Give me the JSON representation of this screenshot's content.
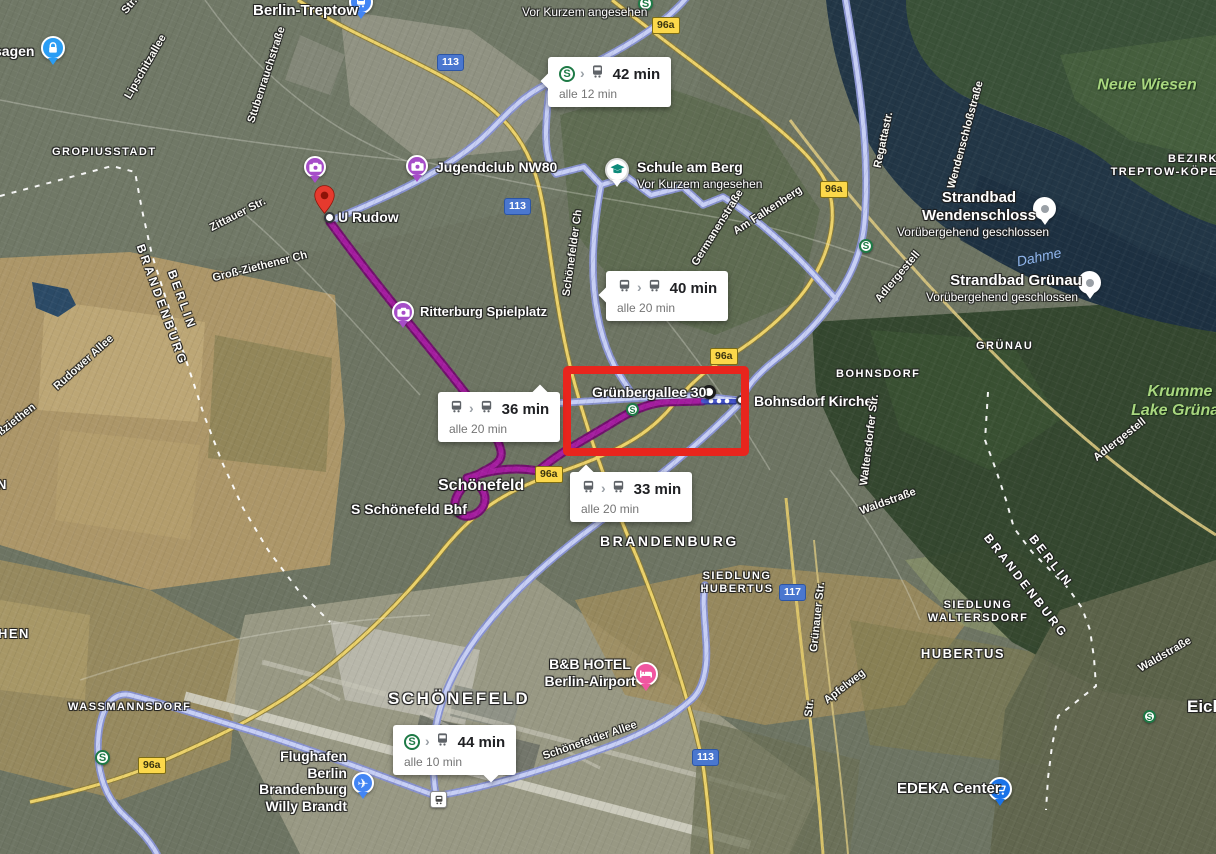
{
  "map": {
    "colors": {
      "transit_route": "#c7cff5",
      "transit_casing": "#8791cf",
      "selected_route": "#a31c9e",
      "selected_casing": "#70106c",
      "blue_route": "#4251c9",
      "blue_casing": "#2b379b",
      "sbahn_green": "#1e7a46",
      "badge_yellow": "#fcd84a",
      "highway_blue": "#4a77cf",
      "highlight_red": "#e8251d"
    },
    "bubbles": [
      {
        "time": "42 min",
        "frequency": "alle 12 min",
        "icons": [
          "sbahn",
          "chevron",
          "train"
        ],
        "x": 548,
        "y": 57,
        "pointer": "left"
      },
      {
        "time": "40 min",
        "frequency": "alle 20 min",
        "icons": [
          "bus",
          "chevron",
          "bus"
        ],
        "x": 606,
        "y": 271,
        "pointer": "left"
      },
      {
        "time": "36 min",
        "frequency": "alle 20 min",
        "icons": [
          "bus",
          "chevron",
          "bus"
        ],
        "x": 438,
        "y": 392,
        "pointer": "top-right"
      },
      {
        "time": "33 min",
        "frequency": "alle 20 min",
        "icons": [
          "bus",
          "chevron",
          "bus"
        ],
        "x": 570,
        "y": 472,
        "pointer": "top-left"
      },
      {
        "time": "44 min",
        "frequency": "alle 10 min",
        "icons": [
          "sbahn",
          "chevron",
          "train"
        ],
        "x": 393,
        "y": 725,
        "pointer": "bottom"
      }
    ],
    "labels": [
      {
        "lines": [
          "Berlin-Treptow"
        ],
        "x": 253,
        "y": 2,
        "kind": "poi",
        "size": 15
      },
      {
        "lines": [
          "Vor Kurzem angesehen"
        ],
        "x": 522,
        "y": 5,
        "kind": "poi-sub"
      },
      {
        "lines": [
          "sagen"
        ],
        "x": -6,
        "y": 43,
        "kind": "poi"
      },
      {
        "lines": [
          "Jugendclub NW80"
        ],
        "x": 436,
        "y": 159,
        "kind": "poi"
      },
      {
        "lines": [
          "U Rudow"
        ],
        "x": 338,
        "y": 209,
        "kind": "poi"
      },
      {
        "lines": [
          "Schule am Berg"
        ],
        "x": 637,
        "y": 159,
        "kind": "poi"
      },
      {
        "lines": [
          "Vor Kurzem angesehen"
        ],
        "x": 637,
        "y": 177,
        "kind": "poi-sub"
      },
      {
        "lines": [
          "Ritterburg Spielplatz"
        ],
        "x": 420,
        "y": 304,
        "kind": "poi",
        "size": 13
      },
      {
        "lines": [
          "Grünbergallee 30"
        ],
        "x": 592,
        "y": 384,
        "kind": "poi"
      },
      {
        "lines": [
          "Bohnsdorf Kirche"
        ],
        "x": 754,
        "y": 393,
        "kind": "poi"
      },
      {
        "lines": [
          "Schönefeld"
        ],
        "x": 438,
        "y": 477,
        "kind": "poi",
        "size": 16
      },
      {
        "lines": [
          "S Schönefeld Bhf"
        ],
        "x": 351,
        "y": 501,
        "kind": "poi"
      },
      {
        "lines": [
          "B&B HOTEL",
          "Berlin-Airport"
        ],
        "x": 590,
        "y": 656,
        "kind": "poi",
        "anchor": "center"
      },
      {
        "lines": [
          "Flughafen",
          "Berlin",
          "Brandenburg",
          "Willy Brandt"
        ],
        "x": 347,
        "y": 748,
        "kind": "poi",
        "anchor": "right"
      },
      {
        "lines": [
          "EDEKA Center"
        ],
        "x": 897,
        "y": 780,
        "kind": "poi",
        "size": 15
      },
      {
        "lines": [
          "Strandbad",
          "Wendenschloss"
        ],
        "x": 979,
        "y": 189,
        "kind": "poi",
        "size": 15,
        "anchor": "center"
      },
      {
        "lines": [
          "Vorübergehend geschlossen"
        ],
        "x": 973,
        "y": 225,
        "kind": "poi-sub",
        "anchor": "center"
      },
      {
        "lines": [
          "Strandbad Grünau"
        ],
        "x": 1016,
        "y": 272,
        "kind": "poi",
        "size": 15,
        "anchor": "center"
      },
      {
        "lines": [
          "Vorübergehend geschlossen"
        ],
        "x": 1002,
        "y": 290,
        "kind": "poi-sub",
        "anchor": "center"
      },
      {
        "lines": [
          "Eichw"
        ],
        "x": 1187,
        "y": 697,
        "kind": "poi",
        "size": 17
      },
      {
        "lines": [
          "GROPIUSSTADT"
        ],
        "x": 52,
        "y": 146,
        "kind": "area"
      },
      {
        "lines": [
          "BOHNSDORF"
        ],
        "x": 836,
        "y": 368,
        "kind": "area"
      },
      {
        "lines": [
          "GRÜNAU"
        ],
        "x": 976,
        "y": 340,
        "kind": "area"
      },
      {
        "lines": [
          "BEZIRK",
          "TREPTOW-KÖPE"
        ],
        "x": 1218,
        "y": 153,
        "kind": "area",
        "anchor": "right"
      },
      {
        "lines": [
          "WASSMANNSDORF"
        ],
        "x": 68,
        "y": 701,
        "kind": "area"
      },
      {
        "lines": [
          "SIEDLUNG",
          "HUBERTUS"
        ],
        "x": 737,
        "y": 570,
        "kind": "area",
        "anchor": "center"
      },
      {
        "lines": [
          "SIEDLUNG",
          "WALTERSDORF"
        ],
        "x": 978,
        "y": 599,
        "kind": "area",
        "anchor": "center"
      },
      {
        "lines": [
          "HUBERTUS"
        ],
        "x": 963,
        "y": 646,
        "kind": "area",
        "size": 13,
        "anchor": "center"
      },
      {
        "lines": [
          "SCHÖNEFELD"
        ],
        "x": 388,
        "y": 689,
        "kind": "area-big"
      },
      {
        "lines": [
          "BRANDENBURG"
        ],
        "x": 600,
        "y": 533,
        "kind": "area-big",
        "size": 14
      },
      {
        "lines": [
          "HEN"
        ],
        "x": -2,
        "y": 626,
        "kind": "area",
        "size": 13
      },
      {
        "lines": [
          "N"
        ],
        "x": -3,
        "y": 477,
        "kind": "area",
        "size": 13
      },
      {
        "lines": [
          "BERLIN"
        ],
        "x": 182,
        "y": 300,
        "kind": "area-border",
        "rot": 70
      },
      {
        "lines": [
          "BRANDENBURG"
        ],
        "x": 162,
        "y": 305,
        "kind": "area-border",
        "rot": 70
      },
      {
        "lines": [
          "BERLIN"
        ],
        "x": 1051,
        "y": 561,
        "kind": "area-border",
        "rot": 52
      },
      {
        "lines": [
          "BRANDENBURG"
        ],
        "x": 1026,
        "y": 586,
        "kind": "area-border",
        "rot": 52
      },
      {
        "lines": [
          "Lipschitzallee"
        ],
        "x": 146,
        "y": 67,
        "kind": "street",
        "rot": -60
      },
      {
        "lines": [
          "Stubenrauchstraße"
        ],
        "x": 267,
        "y": 75,
        "kind": "street",
        "rot": -72
      },
      {
        "lines": [
          "Str."
        ],
        "x": 130,
        "y": 6,
        "kind": "street",
        "rot": -50
      },
      {
        "lines": [
          "Zittauer Str."
        ],
        "x": 238,
        "y": 215,
        "kind": "street",
        "rot": -27
      },
      {
        "lines": [
          "Groß-Ziethener Ch"
        ],
        "x": 260,
        "y": 267,
        "kind": "street",
        "rot": -14
      },
      {
        "lines": [
          "Rudower Allee"
        ],
        "x": 84,
        "y": 363,
        "kind": "street",
        "rot": -42
      },
      {
        "lines": [
          "ßziethen"
        ],
        "x": 17,
        "y": 420,
        "kind": "street",
        "rot": -38
      },
      {
        "lines": [
          "Schönefelder Ch"
        ],
        "x": 573,
        "y": 253,
        "kind": "street",
        "rot": -82
      },
      {
        "lines": [
          "Germanenstraße"
        ],
        "x": 718,
        "y": 228,
        "kind": "street",
        "rot": -58
      },
      {
        "lines": [
          "Am Falkenberg"
        ],
        "x": 768,
        "y": 211,
        "kind": "street",
        "rot": -33
      },
      {
        "lines": [
          "Adlergestell"
        ],
        "x": 898,
        "y": 277,
        "kind": "street",
        "rot": -50
      },
      {
        "lines": [
          "Regattastr."
        ],
        "x": 884,
        "y": 140,
        "kind": "street",
        "rot": -78
      },
      {
        "lines": [
          "Wendenschloßstraße"
        ],
        "x": 966,
        "y": 135,
        "kind": "street",
        "rot": -75
      },
      {
        "lines": [
          "Waltersdorfer Str."
        ],
        "x": 870,
        "y": 440,
        "kind": "street",
        "rot": -83
      },
      {
        "lines": [
          "Waldstraße"
        ],
        "x": 888,
        "y": 502,
        "kind": "street",
        "rot": -20
      },
      {
        "lines": [
          "Adlergestell"
        ],
        "x": 1120,
        "y": 440,
        "kind": "street",
        "rot": -38
      },
      {
        "lines": [
          "Waldstraße"
        ],
        "x": 1165,
        "y": 655,
        "kind": "street",
        "rot": -30
      },
      {
        "lines": [
          "Grünauer Str."
        ],
        "x": 818,
        "y": 617,
        "kind": "street",
        "rot": -84
      },
      {
        "lines": [
          "Str."
        ],
        "x": 810,
        "y": 708,
        "kind": "street",
        "rot": -84
      },
      {
        "lines": [
          "Apfelweg"
        ],
        "x": 845,
        "y": 687,
        "kind": "street",
        "rot": -38
      },
      {
        "lines": [
          "Schönefelder Allee"
        ],
        "x": 590,
        "y": 741,
        "kind": "street",
        "rot": -19
      },
      {
        "lines": [
          "Neue Wiesen"
        ],
        "x": 1147,
        "y": 86,
        "kind": "nature",
        "size": 16,
        "rot": 0
      },
      {
        "lines": [
          "Krumme",
          "Lake Grünau"
        ],
        "x": 1180,
        "y": 402,
        "kind": "nature",
        "size": 16,
        "rot": 0
      },
      {
        "lines": [
          "Dahme"
        ],
        "x": 1039,
        "y": 257,
        "kind": "water",
        "rot": -12
      }
    ],
    "badges": [
      {
        "text": "96a",
        "kind": "route",
        "x": 652,
        "y": 17
      },
      {
        "text": "96a",
        "kind": "route",
        "x": 820,
        "y": 181
      },
      {
        "text": "96a",
        "kind": "route",
        "x": 710,
        "y": 348
      },
      {
        "text": "96a",
        "kind": "route",
        "x": 535,
        "y": 466
      },
      {
        "text": "96a",
        "kind": "route",
        "x": 138,
        "y": 757
      },
      {
        "text": "113",
        "kind": "highway",
        "x": 437,
        "y": 54
      },
      {
        "text": "113",
        "kind": "highway",
        "x": 504,
        "y": 198
      },
      {
        "text": "113",
        "kind": "highway",
        "x": 692,
        "y": 749
      },
      {
        "text": "117",
        "kind": "highway",
        "x": 779,
        "y": 584
      }
    ],
    "s_logos": [
      {
        "x": 638,
        "y": -4,
        "s": 15
      },
      {
        "x": 859,
        "y": 239,
        "s": 14
      },
      {
        "x": 626,
        "y": 403,
        "s": 13
      },
      {
        "x": 95,
        "y": 750,
        "s": 15
      },
      {
        "x": 1143,
        "y": 710,
        "s": 13
      }
    ],
    "markers": [
      {
        "type": "station-blue",
        "x": 349,
        "y": -10,
        "s": 24
      },
      {
        "type": "lock",
        "x": 41,
        "y": 36,
        "s": 24
      },
      {
        "type": "activity",
        "x": 304,
        "y": 156,
        "s": 22
      },
      {
        "type": "activity",
        "x": 406,
        "y": 155,
        "s": 22
      },
      {
        "type": "activity",
        "x": 392,
        "y": 301,
        "s": 22
      },
      {
        "type": "pin-red",
        "x": 314,
        "y": 185,
        "s": 21
      },
      {
        "type": "dot",
        "x": 324,
        "y": 212,
        "s": 11
      },
      {
        "type": "dot-big",
        "x": 702,
        "y": 385,
        "s": 14
      },
      {
        "type": "dot",
        "x": 736,
        "y": 395,
        "s": 10
      },
      {
        "type": "dot",
        "x": 452,
        "y": 505,
        "s": 11
      },
      {
        "type": "school",
        "x": 605,
        "y": 158,
        "s": 24
      },
      {
        "type": "hotel",
        "x": 634,
        "y": 662,
        "s": 24
      },
      {
        "type": "plane",
        "x": 352,
        "y": 772,
        "s": 22
      },
      {
        "type": "station-sq",
        "x": 430,
        "y": 791,
        "s": 15
      },
      {
        "type": "cart",
        "x": 988,
        "y": 777,
        "s": 24
      },
      {
        "type": "pin-white",
        "x": 1033,
        "y": 197,
        "s": 23
      },
      {
        "type": "pin-white",
        "x": 1078,
        "y": 271,
        "s": 23
      }
    ],
    "routes": [
      {
        "kind": "transit",
        "d": "M688,-4 C664,26 610,58 556,80 C521,94 506,116 481,139 C438,177 372,203 330,221"
      },
      {
        "kind": "transit",
        "d": "M845,-4 C855,55 867,125 866,192 C865,224 864,236 858,254 C846,292 813,331 779,357 C757,374 745,388 741,402"
      },
      {
        "kind": "transit",
        "d": "M741,402 C700,444 646,487 594,526 C548,560 508,597 480,633 C457,663 438,700 434,740 C432,768 434,784 436,796"
      },
      {
        "kind": "transit",
        "d": "M436,796 C480,789 542,771 602,749 C642,735 670,719 692,699 C704,688 708,666 706,641 C705,621 702,601 705,585"
      },
      {
        "kind": "transit",
        "d": "M436,796 C392,780 322,753 252,731 C202,716 162,703 130,695 C110,691 99,712 98,744 C97,774 106,799 126,817 C140,830 150,841 157,854"
      },
      {
        "kind": "transit",
        "d": "M549,92 C545,126 543,158 556,174 L584,167 L601,185 L627,177 L651,195 L683,187 L703,205 L723,197 C749,213 778,238 801,261 C813,273 824,286 836,299"
      },
      {
        "kind": "transit",
        "d": "M601,185 C595,219 591,254 594,289 C597,321 605,351 619,374 C626,385 630,391 634,396"
      },
      {
        "kind": "transit",
        "d": "M560,403 L640,398 L700,396 L736,400"
      },
      {
        "kind": "selected",
        "d": "M330,222 C352,252 380,288 408,322 C436,356 462,388 479,411 C491,427 499,441 501,451 C503,461 494,466 484,471 C469,479 457,491 455,502 C454,512 462,519 473,515 C483,511 488,501 483,491 C479,484 472,480 467,478"
      },
      {
        "kind": "selected",
        "d": "M467,478 C492,469 516,467 538,471 C560,452 586,439 612,423 C631,411 646,404 665,402 L703,401"
      },
      {
        "kind": "blue",
        "d": "M703,401 L739,401"
      }
    ],
    "walk_dots": [
      {
        "x": 711,
        "y": 401
      },
      {
        "x": 719,
        "y": 401
      },
      {
        "x": 727,
        "y": 401
      }
    ],
    "highlight_box": {
      "x": 563,
      "y": 366,
      "w": 170,
      "h": 74,
      "border": 8,
      "color": "#e8251d"
    }
  }
}
